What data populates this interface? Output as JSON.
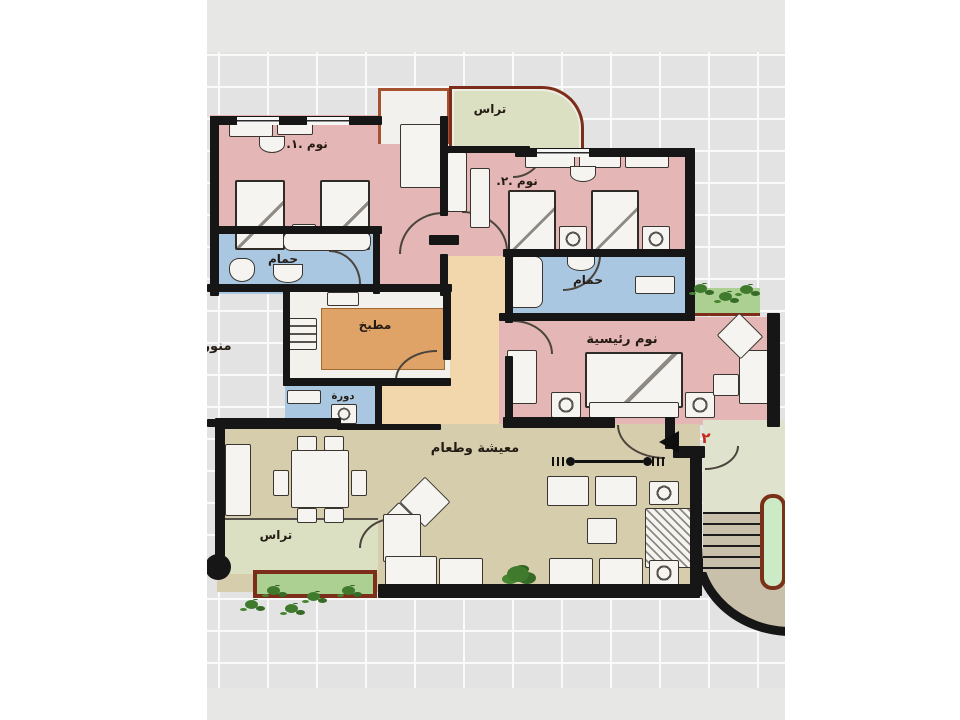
{
  "plan": {
    "labels": {
      "terrace_top": "تراس",
      "bedroom1": "نوم .١.",
      "bedroom2": "نوم .٢.",
      "bathroom1": "حمام",
      "bathroom2": "حمام",
      "kitchen": "مطبخ",
      "light_well": "منور",
      "wc": "دورة",
      "master_bedroom": "نوم رئيسية",
      "living_dining": "معيشة وطعام",
      "terrace_bottom": "تراس",
      "unit_number": "٢"
    },
    "colors": {
      "bedroom_fill": "#e4b6b6",
      "bathroom_fill": "#aac7e2",
      "hall_fill": "#f2d6ac",
      "kitchen_floor_fill": "#dfa368",
      "terrace_fill": "#dce0c3",
      "living_fill": "#d6cdad",
      "landing_fill": "#dfe2cc",
      "stairs_fill": "#c9c0ab",
      "planter_fill": "#accf92",
      "plant_green": "#3f7a2d",
      "wall": "#161616",
      "terrace_border": "#7d2e1a",
      "grid_background": "#e3e3e3",
      "unit_number_red": "#c4281e"
    }
  }
}
